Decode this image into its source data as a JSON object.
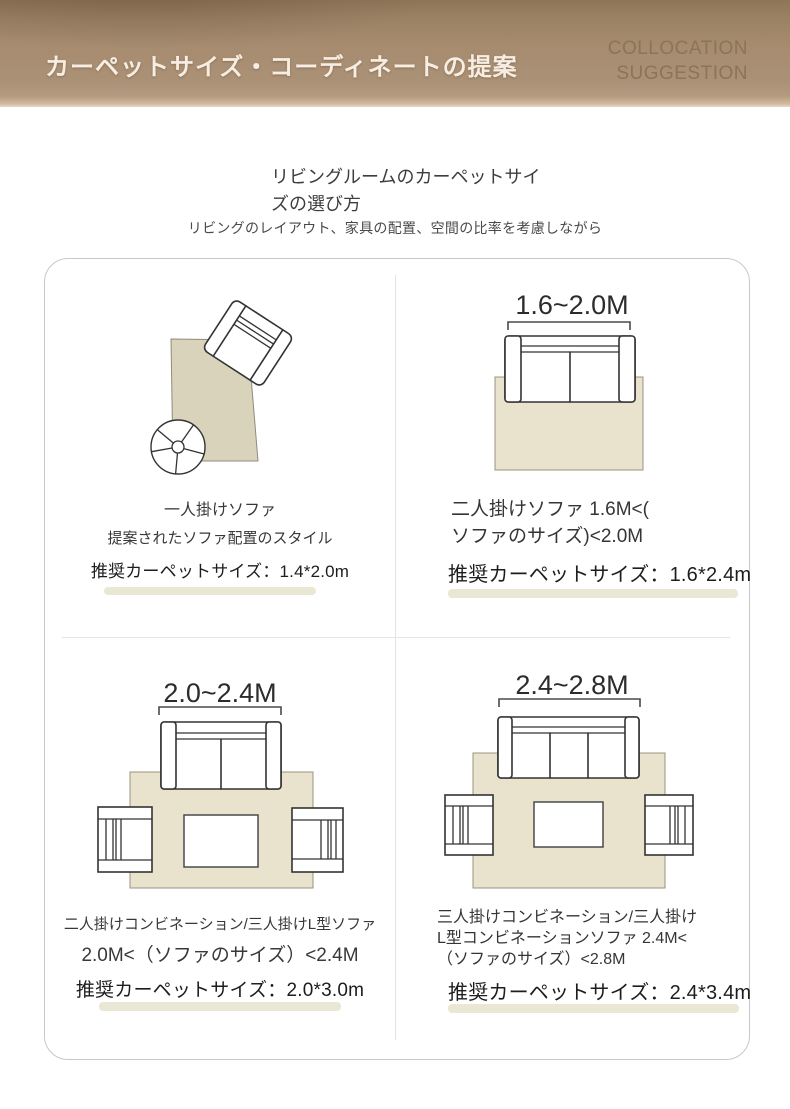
{
  "header": {
    "title": "カーペットサイズ・コーディネートの提案",
    "subtitle_lines": [
      "COLLOCATION",
      "SUGGESTION"
    ]
  },
  "intro": {
    "title_lines": [
      "リビングルームのカーペットサイ",
      "ズの選び方"
    ],
    "subtitle": "リビングのレイアウト、家具の配置、空間の比率を考慮しながら"
  },
  "quadrants": [
    {
      "id": "single-sofa",
      "dimension_label": "",
      "caption_lines": [
        "一人掛けソファ",
        "提案されたソファ配置のスタイル"
      ],
      "recommendation": "推奨カーペットサイズ：1.4*2.0m"
    },
    {
      "id": "two-seater-sofa",
      "dimension_label": "1.6~2.0M",
      "caption_lines": [
        "二人掛けソファ 1.6M<(",
        "ソファのサイズ)<2.0M"
      ],
      "recommendation": "推奨カーペットサイズ：1.6*2.4m"
    },
    {
      "id": "two-seat-combination",
      "dimension_label": "2.0~2.4M",
      "caption_lines": [
        "二人掛けコンビネーション/三人掛けL型ソファ",
        "2.0M<（ソファのサイズ）<2.4M"
      ],
      "recommendation": "推奨カーペットサイズ：2.0*3.0m"
    },
    {
      "id": "three-seat-combination",
      "dimension_label": "2.4~2.8M",
      "caption_lines": [
        "三人掛けコンビネーション/三人掛け",
        "L型コンビネーションソファ 2.4M<",
        "（ソファのサイズ）<2.8M"
      ],
      "recommendation": "推奨カーペットサイズ：2.4*3.4m"
    }
  ],
  "icons": {
    "rug-icon": "beige rectangle top view",
    "sofa-icon": "sofa top view outline",
    "armchair-icon": "armchair top view outline",
    "coffee-table-icon": "white rectangle outline",
    "ball-icon": "circle with spokes",
    "measure-bracket-icon": "bracket with end ticks"
  },
  "colors": {
    "header_brown": "#a68b6f",
    "rug_beige": "#e9e2cc",
    "rug_dark_beige": "#d9d3bb",
    "highlight_bar": "#eae8d5",
    "panel_border": "#c8c8c8"
  }
}
